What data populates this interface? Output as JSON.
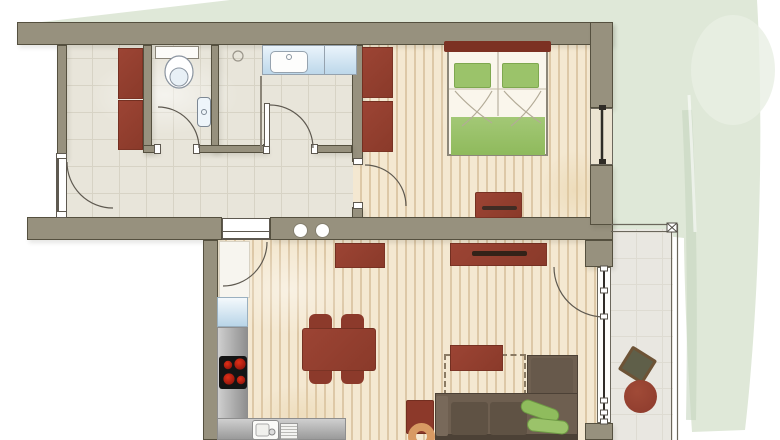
{
  "title": "Apartment floor plan (top-down architectural drawing, no text labels)",
  "colors": {
    "wall": "#97917e",
    "wallEdge": "#55503f",
    "tile": "#e8e5da",
    "tileLine": "#d7d3c5",
    "wood": "#f4e8d1",
    "woodStripe": "#ddc8a7",
    "red": "#9c4434",
    "redDark": "#7c3123",
    "green": "#9bc36a",
    "sofa": "#6e5f50",
    "sofaCushion": "#5f5244",
    "counter": "#b9b9b9",
    "blue": "#cfe3f1",
    "balconyFloor": "#e9e7e1",
    "garden": "#dfe8d8",
    "gardenShade": "#c7d6bf",
    "tan": "#d89a63",
    "line": "#5e5950"
  },
  "rooms": [
    {
      "id": "hallway",
      "floor": "tile"
    },
    {
      "id": "wc",
      "floor": "tile"
    },
    {
      "id": "bathroom",
      "floor": "tile"
    },
    {
      "id": "bedroom",
      "floor": "wood"
    },
    {
      "id": "living-room-kitchen",
      "floor": "wood"
    },
    {
      "id": "balcony",
      "floor": "stone"
    },
    {
      "id": "garden",
      "floor": "grass"
    }
  ],
  "furniture": [
    {
      "id": "hall-wardrobe",
      "room": "hallway",
      "color": "red"
    },
    {
      "id": "toilet",
      "room": "wc"
    },
    {
      "id": "wc-hand-basin",
      "room": "wc"
    },
    {
      "id": "shower",
      "room": "bathroom"
    },
    {
      "id": "vanity-sink",
      "room": "bathroom"
    },
    {
      "id": "wardrobe-upper",
      "room": "bedroom",
      "color": "red"
    },
    {
      "id": "wardrobe-lower",
      "room": "bedroom",
      "color": "red"
    },
    {
      "id": "double-bed",
      "room": "bedroom",
      "pillows": "green",
      "blanket": "green"
    },
    {
      "id": "bed-bench",
      "room": "bedroom",
      "color": "red"
    },
    {
      "id": "kitchen-tall-cabinet",
      "room": "living-room-kitchen"
    },
    {
      "id": "fridge",
      "room": "living-room-kitchen"
    },
    {
      "id": "kitchen-counter-l-shape",
      "room": "living-room-kitchen"
    },
    {
      "id": "cooktop-4-burners",
      "room": "living-room-kitchen"
    },
    {
      "id": "kitchen-sink",
      "room": "living-room-kitchen"
    },
    {
      "id": "dining-table",
      "room": "living-room-kitchen",
      "chairs": 4,
      "color": "red"
    },
    {
      "id": "sideboard",
      "room": "living-room-kitchen",
      "color": "red"
    },
    {
      "id": "tv-lowboard",
      "room": "living-room-kitchen",
      "color": "red"
    },
    {
      "id": "coffee-table",
      "room": "living-room-kitchen",
      "color": "red"
    },
    {
      "id": "rug-dashed-outline",
      "room": "living-room-kitchen"
    },
    {
      "id": "corner-sofa",
      "room": "living-room-kitchen",
      "pillows": "green"
    },
    {
      "id": "armchair",
      "room": "living-room-kitchen",
      "color": "red"
    },
    {
      "id": "pouf-ring",
      "room": "living-room-kitchen",
      "color": "tan"
    },
    {
      "id": "balcony-table",
      "room": "balcony"
    },
    {
      "id": "balcony-chair",
      "room": "balcony",
      "color": "red"
    }
  ],
  "openings": [
    {
      "id": "entry-door",
      "wall": "left"
    },
    {
      "id": "wc-door"
    },
    {
      "id": "bathroom-door"
    },
    {
      "id": "bedroom-door"
    },
    {
      "id": "living-room-door"
    },
    {
      "id": "balcony-door"
    },
    {
      "id": "bedroom-window"
    },
    {
      "id": "living-glass-front"
    }
  ]
}
